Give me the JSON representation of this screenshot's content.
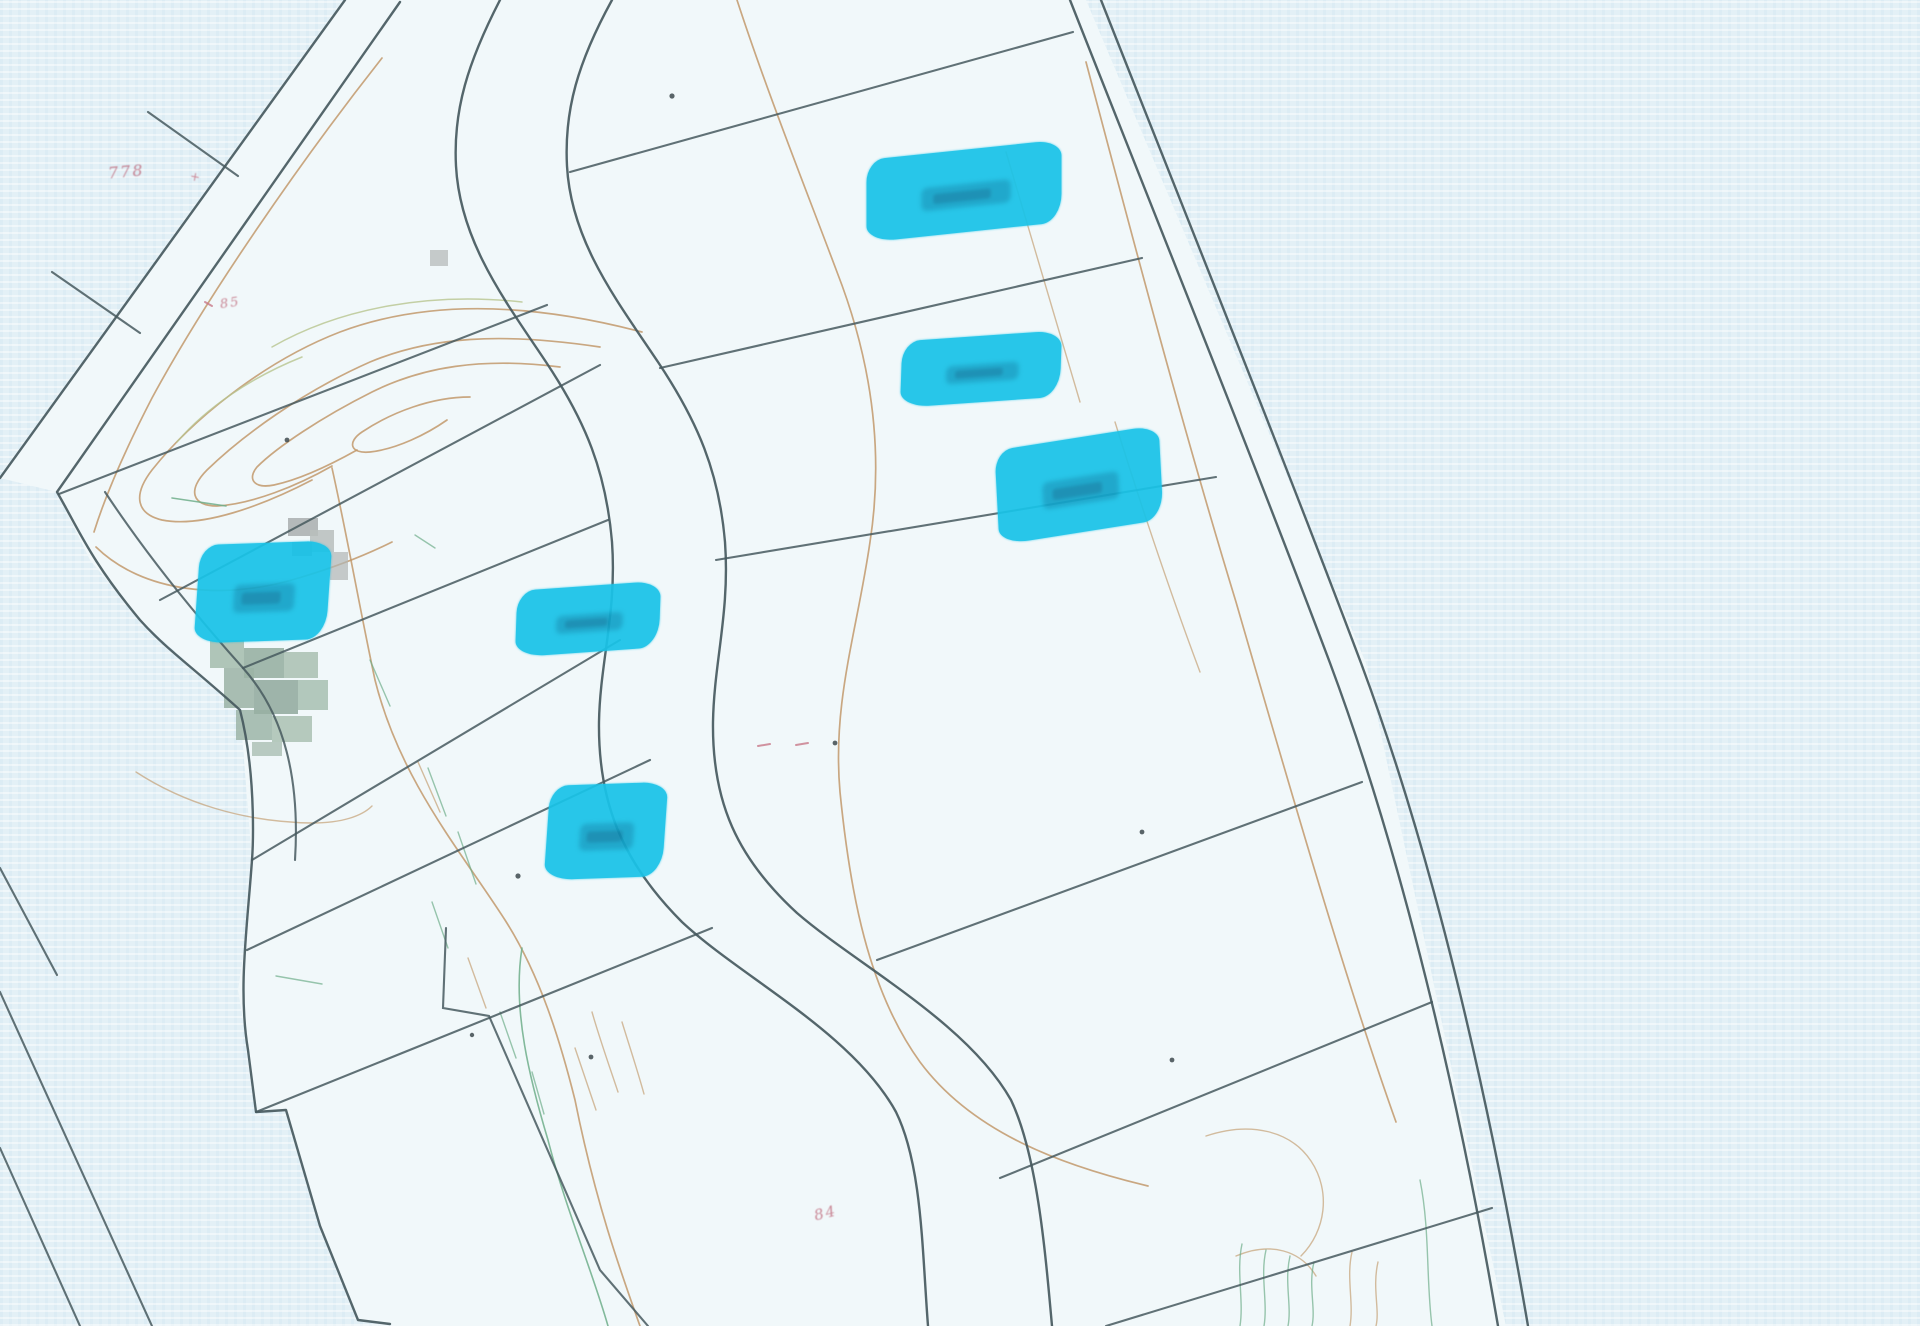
{
  "map": {
    "description": "Scanned cadastral parcel map with highlighted plots",
    "palette": {
      "paper_background": "#e3f0f6",
      "parcel_fill": "#f1f8fa",
      "boundary_line": "#47595e",
      "contour_line": "#c2996b",
      "vegetation_mark": "#6fae8a",
      "highlight": "#19c3e8",
      "annotation_red": "#b8566a",
      "patch_gray": "#a9aeae",
      "patch_green": "#9bb3a5"
    },
    "red_labels": [
      {
        "text": "778",
        "x": 108,
        "y": 162,
        "size": 16,
        "rot": -5
      },
      {
        "text": "+",
        "x": 190,
        "y": 170,
        "size": 12,
        "rot": 10
      },
      {
        "text": "85",
        "x": 220,
        "y": 296,
        "size": 13,
        "rot": -8
      },
      {
        "text": "84",
        "x": 814,
        "y": 1204,
        "size": 15,
        "rot": -14
      }
    ],
    "highlighted_parcels": [
      {
        "name": "parcel-highlight-1",
        "x": 866,
        "y": 150,
        "w": 196,
        "h": 82,
        "rot": -6
      },
      {
        "name": "parcel-highlight-2",
        "x": 901,
        "y": 336,
        "w": 160,
        "h": 66,
        "rot": -4
      },
      {
        "name": "parcel-highlight-3",
        "x": 996,
        "y": 438,
        "w": 166,
        "h": 94,
        "rot": -9
      },
      {
        "name": "parcel-highlight-4",
        "x": 197,
        "y": 543,
        "w": 132,
        "h": 98,
        "rot": -2
      },
      {
        "name": "parcel-highlight-5",
        "x": 516,
        "y": 586,
        "w": 144,
        "h": 66,
        "rot": -4
      },
      {
        "name": "parcel-highlight-6",
        "x": 547,
        "y": 784,
        "w": 118,
        "h": 94,
        "rot": -2
      }
    ]
  }
}
